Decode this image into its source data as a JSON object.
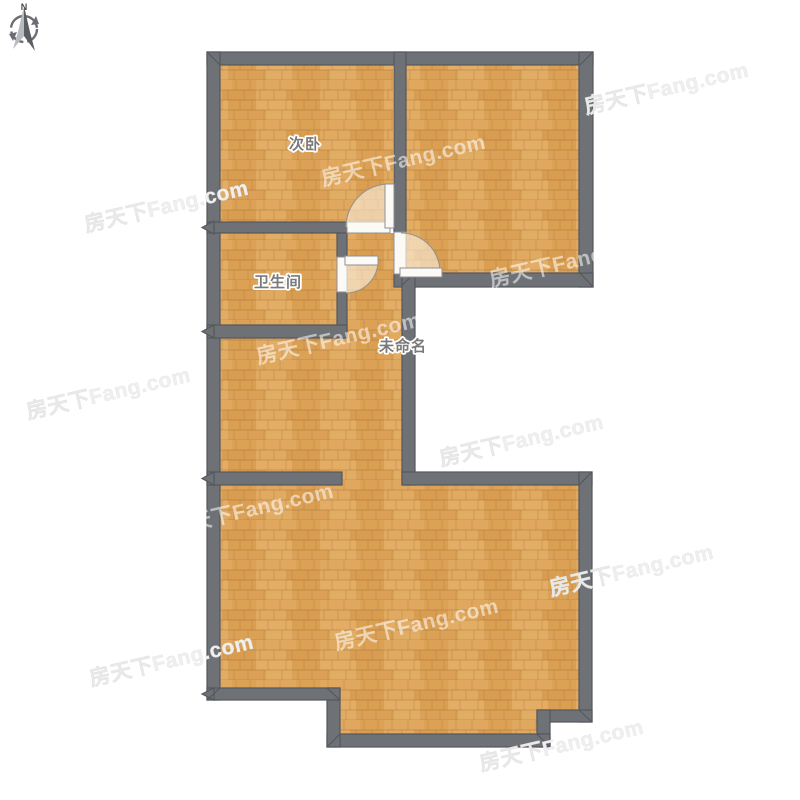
{
  "compass": {
    "label": "N"
  },
  "watermark": {
    "text": "房天下Fang.com"
  },
  "rooms": {
    "bedroom2": {
      "label": "次卧"
    },
    "bathroom": {
      "label": "卫生间"
    },
    "unnamed": {
      "label": "未命名"
    }
  },
  "colors": {
    "wall": "#6e7176",
    "wall-edge": "#54575c",
    "floor-base": "#dda45b",
    "label-color": "#7a7a7a",
    "door-white": "#fbfaf6"
  }
}
